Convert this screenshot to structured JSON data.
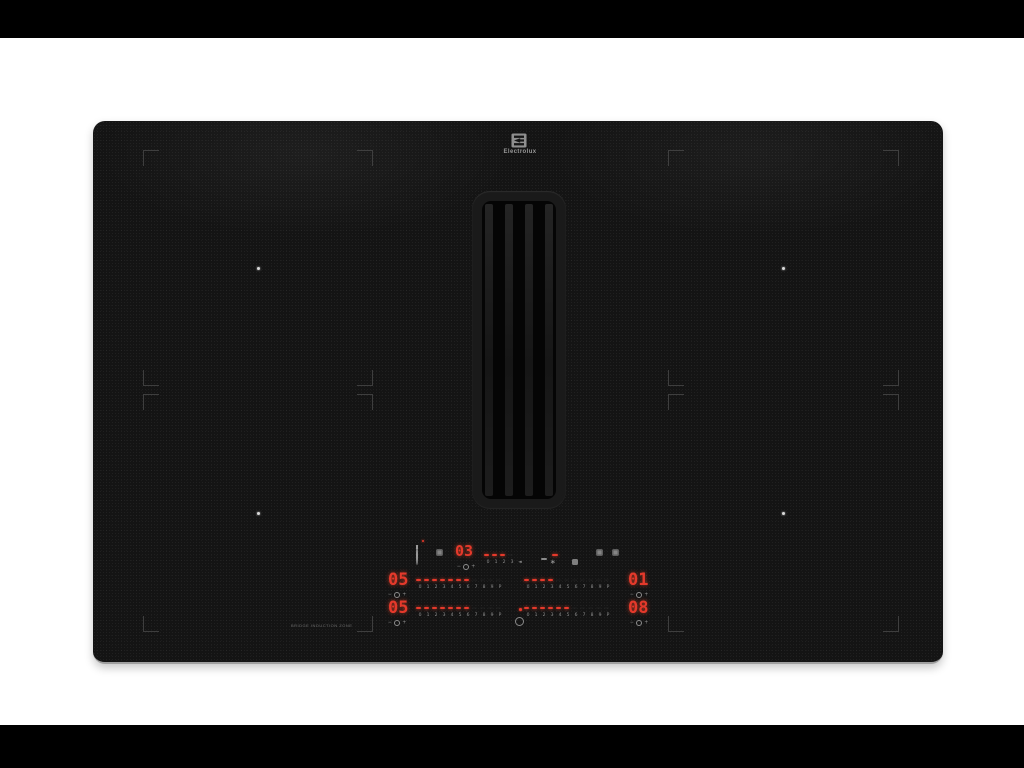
{
  "brand": {
    "wordmark": "Electrolux"
  },
  "colors": {
    "letterbox": "#000000",
    "background": "#ffffff",
    "glass": "#141414",
    "led_red": "#e5392b",
    "icon_gray": "#9a9a9a"
  },
  "hood_controls": {
    "display": "03",
    "segments_total": 4,
    "segments_lit": 3,
    "scale": [
      "0",
      "1",
      "2",
      "3",
      "◄"
    ],
    "fan_glyph": "∗",
    "mini": {
      "minus": "−",
      "plus": "+"
    }
  },
  "zone_controls": {
    "scale": [
      "0",
      "1",
      "2",
      "3",
      "4",
      "5",
      "6",
      "7",
      "8",
      "9",
      "P"
    ],
    "rows": [
      {
        "left_display": "05",
        "left_segments_lit": 7,
        "right_segments_lit": 4,
        "right_display": "01"
      },
      {
        "left_display": "05",
        "left_segments_lit": 7,
        "right_segments_lit": 6,
        "right_display": "08"
      }
    ],
    "mini": {
      "minus": "−",
      "plus": "+"
    }
  },
  "small_print": "Bridge induction zone"
}
